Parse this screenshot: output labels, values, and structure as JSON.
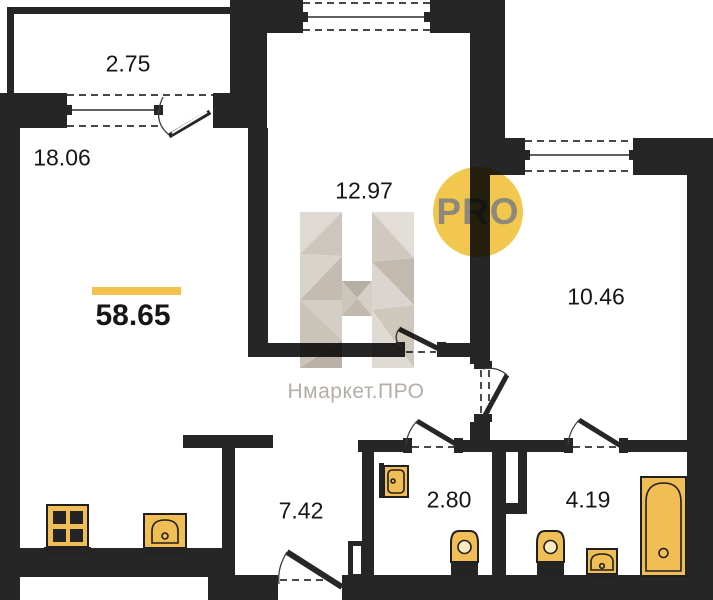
{
  "plan": {
    "total_area": "58.65",
    "rooms": {
      "balcony": {
        "area": "2.75"
      },
      "living_room": {
        "area": "18.06"
      },
      "bedroom": {
        "area": "12.97"
      },
      "bedroom2": {
        "area": "10.46"
      },
      "hallway": {
        "area": "7.42"
      },
      "bathroom": {
        "area": "2.80"
      },
      "bathroom2": {
        "area": "4.19"
      }
    }
  },
  "watermark": {
    "brand": "Нмаркет.ПРО",
    "badge": "PRO"
  },
  "icons": [
    "stove-icon",
    "kitchen-sink-icon",
    "wash-sink-icon",
    "toilet-icon",
    "bathtub-icon"
  ],
  "colors": {
    "wall": "#262626",
    "fixture": "#F1BD55",
    "accentBar": "#F2C14E",
    "badgeBg": "#F2C74E",
    "badgeText": "#8D887B",
    "watermarkText": "#B3AEA7"
  }
}
